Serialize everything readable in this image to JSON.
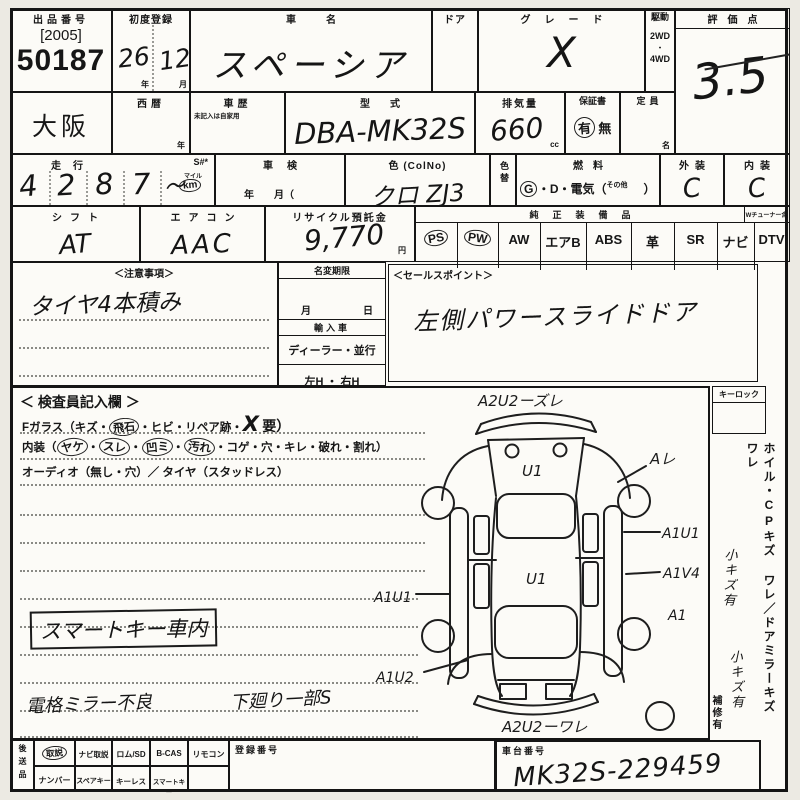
{
  "top": {
    "auction": {
      "label": "出品番号",
      "year": "[2005]",
      "number": "50187"
    },
    "first_reg": {
      "label": "初度登録",
      "year": "26",
      "year_unit": "年",
      "month": "12",
      "month_unit": "月"
    },
    "car_name": {
      "label": "車名",
      "value": "スペーシア"
    },
    "door": {
      "label": "ドア"
    },
    "grade": {
      "label": "グレード",
      "value": "X"
    },
    "drive": {
      "label": "駆動",
      "opt1": "2WD",
      "dot": "・",
      "opt2": "4WD"
    },
    "score": {
      "label": "評価点",
      "value": "3.5"
    }
  },
  "row2": {
    "region": "大阪",
    "western": {
      "label": "西暦",
      "unit": "年"
    },
    "history": {
      "label": "車歴",
      "note": "未記入は自家用"
    },
    "model": {
      "label": "型式",
      "value": "DBA-MK32S"
    },
    "displacement": {
      "label": "排気量",
      "value": "660",
      "unit": "cc"
    },
    "warranty": {
      "label": "保証書",
      "yes": "有",
      "no": "無"
    },
    "capacity": {
      "label": "定員",
      "unit": "名"
    }
  },
  "row3": {
    "mileage": {
      "label": "走行",
      "s_label": "S#*",
      "digits": [
        "4",
        "2",
        "8",
        "7"
      ],
      "flourish": "〜",
      "unit": "km",
      "unit_alt": "マイル"
    },
    "inspection": {
      "label": "車検",
      "fields": "年　　月（"
    },
    "color": {
      "label": "色 (ColNo)",
      "value": "クロ ZJ3"
    },
    "color_change": {
      "label": "色替"
    },
    "fuel": {
      "label": "燃料",
      "g": "G",
      "rest": "・D・電気（",
      "other": "その他",
      "close": "）"
    },
    "exterior": {
      "label": "外装",
      "value": "C"
    },
    "interior": {
      "label": "内装",
      "value": "C"
    }
  },
  "row4": {
    "shift": {
      "label": "シフト",
      "value": "AT"
    },
    "aircon": {
      "label": "エアコン",
      "value": "AAC"
    },
    "recycle": {
      "label": "リサイクル預託金",
      "value": "9,770",
      "unit": "円"
    },
    "equipment": {
      "label": "純正装備品",
      "note": "Wチューナー含",
      "items": [
        "PS",
        "PW",
        "AW",
        "エアB",
        "ABS",
        "革",
        "SR",
        "ナビ",
        "DTV"
      ]
    }
  },
  "notes": {
    "caution": {
      "label": "＜注意事項＞",
      "text": "タイヤ4本積み"
    },
    "name_change": {
      "label": "名変期限",
      "month": "月",
      "day": "日",
      "import_label": "輸入車",
      "dealer": "ディーラー・並行",
      "handle": "左H ・ 右H"
    },
    "sales": {
      "label": "＜セールスポイント＞",
      "text": "左側パワースライドドア"
    }
  },
  "inspector": {
    "title": "＜ 検査員記入欄 ＞",
    "fglass": {
      "prefix": "Fガラス（キズ・",
      "circled": "飛石",
      "mid": "・ヒビ・リペア跡・",
      "mark": "X",
      "suffix": "要）"
    },
    "interior_line": {
      "prefix": "内装（",
      "circled_items": [
        "ヤケ",
        "スレ",
        "凹ミ",
        "汚れ"
      ],
      "sep": "・",
      "tail": "コゲ・穴・キレ・破れ・割れ）"
    },
    "audio_line": "オーディオ（無し・穴）／ タイヤ（スタッドレス）",
    "boxed_note": "スマートキー車内",
    "note_left": "電格ミラー不良",
    "note_right": "下廻り一部S"
  },
  "diagram": {
    "front_label": "A2U2ーズレ",
    "hood_mark": "U1",
    "roof_mark": "U1",
    "right_fender": "Aレ",
    "right_front_door": "A1U1",
    "right_rear_door": "A1V4",
    "right_rear": "A1",
    "left_door": "A1U1",
    "left_rear": "A1U2",
    "rear_label": "A2U2ーワレ"
  },
  "right_panel": {
    "keylock": "キーロック",
    "wheel": "ホイル・CPキズ ワレ",
    "slash": "／",
    "mirror": "ドアミラーキズ ワレ",
    "repair": "補修有",
    "hw_wheel": "小キズ有",
    "hw_mirror": "小キズ有"
  },
  "bottom": {
    "send_label": "後送品",
    "row1": [
      "取説",
      "ナビ取説",
      "ロム/SD",
      "B-CAS",
      "リモコン"
    ],
    "row2": [
      "ナンバー",
      "スペアキー",
      "キーレス",
      "スマートキー"
    ],
    "reg": {
      "label": "登録番号"
    },
    "chassis": {
      "label": "車台番号",
      "value": "MK32S-229459"
    }
  }
}
